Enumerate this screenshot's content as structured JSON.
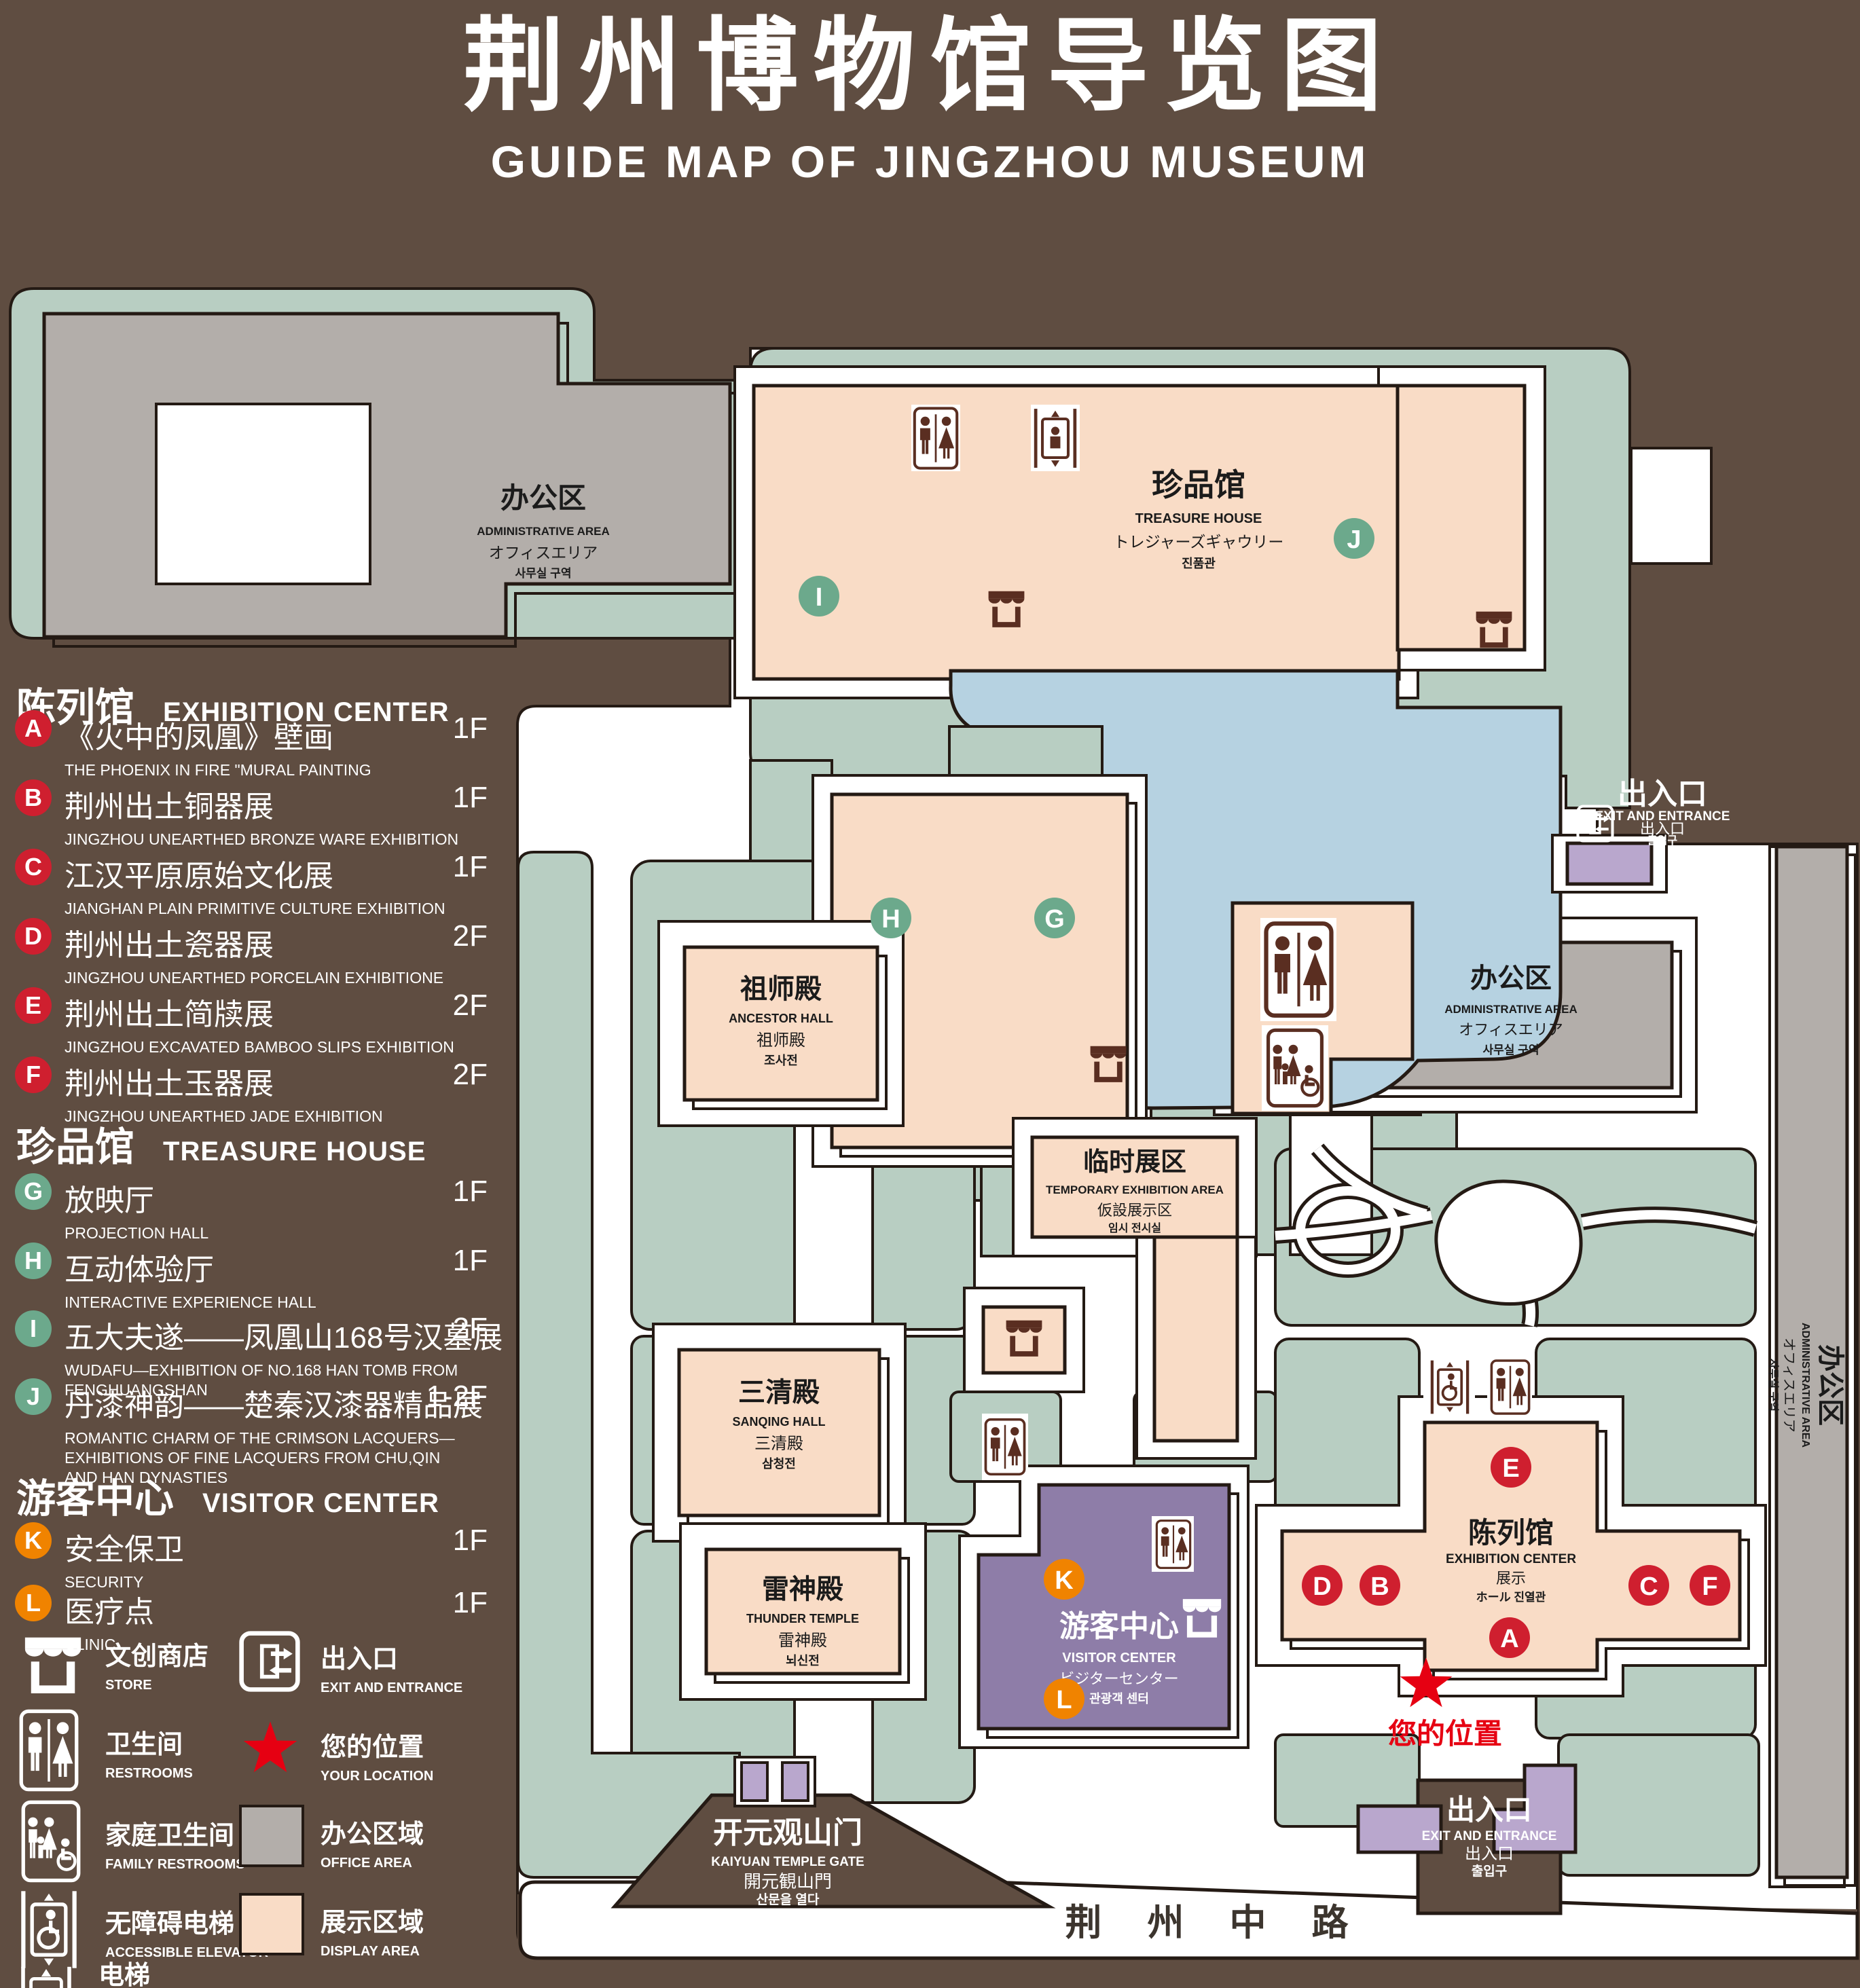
{
  "title": {
    "zh": "荆州博物馆导览图",
    "en": "GUIDE MAP OF JINGZHOU MUSEUM"
  },
  "legend": {
    "sections": [
      {
        "zh": "陈列馆",
        "en": "EXHIBITION CENTER",
        "items": [
          {
            "letter": "A",
            "zh": "《火中的凤凰》壁画",
            "en": "THE PHOENIX IN FIRE \"MURAL PAINTING",
            "floor": "1F"
          },
          {
            "letter": "B",
            "zh": "荆州出土铜器展",
            "en": "JINGZHOU UNEARTHED BRONZE WARE EXHIBITION",
            "floor": "1F"
          },
          {
            "letter": "C",
            "zh": "江汉平原原始文化展",
            "en": "JIANGHAN PLAIN PRIMITIVE CULTURE EXHIBITION",
            "floor": "1F"
          },
          {
            "letter": "D",
            "zh": "荆州出土瓷器展",
            "en": "JINGZHOU UNEARTHED PORCELAIN EXHIBITIONE",
            "floor": "2F"
          },
          {
            "letter": "E",
            "zh": "荆州出土简牍展",
            "en": "JINGZHOU EXCAVATED BAMBOO SLIPS EXHIBITION",
            "floor": "2F"
          },
          {
            "letter": "F",
            "zh": "荆州出土玉器展",
            "en": "JINGZHOU UNEARTHED JADE EXHIBITION",
            "floor": "2F"
          }
        ]
      },
      {
        "zh": "珍品馆",
        "en": "TREASURE HOUSE",
        "items": [
          {
            "letter": "G",
            "zh": "放映厅",
            "en": "PROJECTION HALL",
            "floor": "1F"
          },
          {
            "letter": "H",
            "zh": "互动体验厅",
            "en": "INTERACTIVE EXPERIENCE HALL",
            "floor": "1F"
          },
          {
            "letter": "I",
            "zh": "五大夫遂——凤凰山168号汉墓展",
            "en": "WUDAFU—EXHIBITION OF NO.168 HAN TOMB FROM FENGHUANGSHAN",
            "floor": "2F"
          },
          {
            "letter": "J",
            "zh": "丹漆神韵——楚秦汉漆器精品展",
            "en": "ROMANTIC CHARM OF THE CRIMSON LACQUERS—EXHIBITIONS OF FINE LACQUERS FROM CHU,QIN AND HAN DYNASTIES",
            "floor": "1-2F"
          }
        ]
      },
      {
        "zh": "游客中心",
        "en": "VISITOR CENTER",
        "items": [
          {
            "letter": "K",
            "zh": "安全保卫",
            "en": "SECURITY",
            "floor": "1F"
          },
          {
            "letter": "L",
            "zh": "医疗点",
            "en": "CLINIC",
            "floor": "1F"
          }
        ]
      }
    ],
    "facilities_left": [
      {
        "icon": "store-icon",
        "zh": "文创商店",
        "en": "STORE"
      },
      {
        "icon": "restroom-icon",
        "zh": "卫生间",
        "en": "RESTROOMS"
      },
      {
        "icon": "family-restroom-icon",
        "zh": "家庭卫生间",
        "en": "FAMILY RESTROOMS"
      },
      {
        "icon": "accessible-elevator-icon",
        "zh": "无障碍电梯",
        "en": "ACCESSIBLE ELEVATOR"
      },
      {
        "icon": "elevator-icon",
        "zh": "电梯",
        "en": "Elevator"
      }
    ],
    "facilities_right": [
      {
        "icon": "exit-icon",
        "zh": "出入口",
        "en": "EXIT AND ENTRANCE"
      },
      {
        "icon": "your-location-star",
        "zh": "您的位置",
        "en": "YOUR LOCATION"
      },
      {
        "icon": "office-area-swatch",
        "zh": "办公区域",
        "en": "OFFICE AREA"
      },
      {
        "icon": "display-area-swatch",
        "zh": "展示区域",
        "en": "DISPLAY AREA"
      }
    ]
  },
  "map": {
    "admin1": {
      "zh": "办公区",
      "en": "ADMINISTRATIVE AREA",
      "ja": "オフィスエリア",
      "ko": "사무실 구역"
    },
    "admin2": {
      "zh": "办公区",
      "en": "ADMINISTRATIVE AREA",
      "ja": "オフィスエリア",
      "ko": "사무실 구역"
    },
    "admin3": {
      "zh": "办公区",
      "en": "ADMINISTRATIVE AREA",
      "ja": "オフィスエリア",
      "ko": "사무실 구역"
    },
    "treasure": {
      "zh": "珍品馆",
      "en": "TREASURE HOUSE",
      "ja": "トレジャーズギャウリー",
      "ko": "진품관"
    },
    "ancestor": {
      "zh": "祖师殿",
      "en": "ANCESTOR HALL",
      "ja": "祖师殿",
      "ko": "조사전"
    },
    "sanqing": {
      "zh": "三清殿",
      "en": "SANQING HALL",
      "ja": "三清殿",
      "ko": "삼청전"
    },
    "thunder": {
      "zh": "雷神殿",
      "en": "THUNDER TEMPLE",
      "ja": "雷神殿",
      "ko": "뇌신전"
    },
    "temporary": {
      "zh": "临时展区",
      "en": "TEMPORARY EXHIBITION AREA",
      "ja": "仮設展示区",
      "ko": "임시 전시실"
    },
    "visitor": {
      "zh": "游客中心",
      "en": "VISITOR CENTER",
      "ja": "ビジターセンター",
      "ko": "관광객 센터"
    },
    "exhibition": {
      "zh": "陈列馆",
      "en": "EXHIBITION CENTER",
      "ja": "展示",
      "ko": "ホール 진열관"
    },
    "gate": {
      "zh": "开元观山门",
      "en": "KAIYUAN TEMPLE GATE",
      "ja": "開元観山門",
      "ko": "산문을 열다"
    },
    "exit_top": {
      "zh": "出入口",
      "en": "EXIT AND ENTRANCE",
      "ja": "出入口",
      "ko": "출입구"
    },
    "exit_bottom": {
      "zh": "出入口",
      "en": "EXIT AND ENTRANCE",
      "ja": "出入口",
      "ko": "출입구"
    },
    "your_location": "您的位置",
    "road": "荆 州 中 路",
    "markers": {
      "a": "A",
      "b": "B",
      "c": "C",
      "d": "D",
      "e": "E",
      "f": "F",
      "g": "G",
      "h": "H",
      "i": "I",
      "j": "J",
      "k": "K",
      "l": "L"
    }
  },
  "colors": {
    "background": "#5f4d41",
    "lawn": "#b8cec2",
    "display_building": "#f9dcc6",
    "office_building": "#b3aeaa",
    "water": "#b6d2e1",
    "purple_gate": "#b9a7cd",
    "badge_red": "#cf1f2f",
    "badge_green": "#6ca98c",
    "badge_orange": "#f08300",
    "star_red": "#e60012",
    "outline": "#241a14"
  }
}
